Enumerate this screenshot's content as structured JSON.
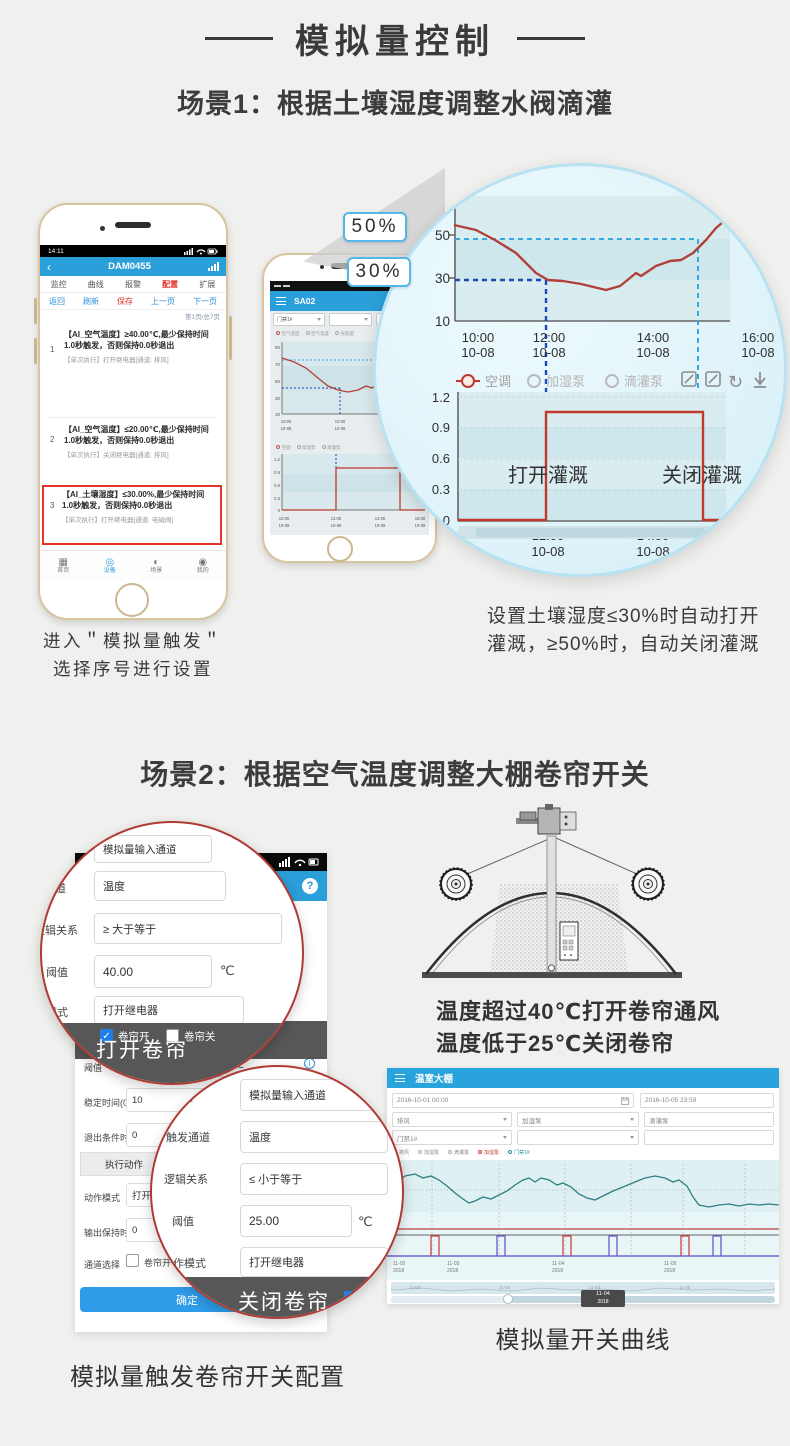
{
  "ui": {
    "back": "‹",
    "help": "?",
    "info": "i",
    "check": "✓"
  },
  "header": {
    "title": "模拟量控制"
  },
  "scene1": {
    "title": "场景1：根据土壤湿度调整水阀滴灌",
    "phone1": {
      "time": "14:11",
      "app_title": "DAM0455",
      "tabs": [
        "监控",
        "曲线",
        "报警",
        "配置",
        "扩展"
      ],
      "toolbar": [
        "返回",
        "刷新",
        "保存",
        "上一页",
        "下一页"
      ],
      "page_indicator": "第1页/总7页",
      "rules": [
        {
          "no": "1",
          "title": "【AI_空气温度】≥40.00℃,最少保持时间1.0秒触发，否则保持0.0秒退出",
          "action": "【单次执行】打开继电器[通道: 排风]"
        },
        {
          "no": "2",
          "title": "【AI_空气温度】≤20.00℃,最少保持时间1.0秒触发，否则保持0.0秒退出",
          "action": "【单次执行】关闭继电器[通道: 排风]"
        },
        {
          "no": "3",
          "title": "【AI_土壤湿度】≤30.00%,最少保持时间1.0秒触发，否则保持0.0秒退出",
          "action": "【单次执行】打开继电器[通道: 电磁阀]"
        }
      ],
      "nav": [
        "首页",
        "设备",
        "场景",
        "我的"
      ],
      "caption1": "进入＂模拟量触发＂",
      "caption2": "选择序号进行设置"
    },
    "phone2": {
      "app_title": "SA02",
      "device_select": "门禁1#",
      "legend1": [
        "空气湿度",
        "空气温度",
        "光照度"
      ],
      "yticks1": [
        "90",
        "70",
        "50",
        "30",
        "10"
      ],
      "xticks1": [
        "10:00",
        "12:00",
        "14:00"
      ],
      "xdate": "10-08",
      "legend2": [
        "空调",
        "加湿泵",
        "滴灌泵"
      ],
      "yticks2": [
        "1.2",
        "0.9",
        "0.6",
        "0.3",
        "0"
      ],
      "xticks2": [
        "10:00",
        "12:00",
        "14:00",
        "16:00"
      ]
    },
    "callout_high": "50%",
    "callout_low": "30%",
    "mag": {
      "hum_yticks": [
        "50",
        "30",
        "10"
      ],
      "hum_xticks": [
        {
          "t": "10:00",
          "d": "10-08"
        },
        {
          "t": "12:00",
          "d": "10-08"
        },
        {
          "t": "14:00",
          "d": "10-08"
        },
        {
          "t": "16:00",
          "d": "10-08"
        }
      ],
      "legend": [
        "空调",
        "加湿泵",
        "滴灌泵"
      ],
      "legend_sub": "门禁1#",
      "sw_yticks": [
        "1.2",
        "0.9",
        "0.6",
        "0.3",
        "0"
      ],
      "sw_xticks": [
        {
          "t": "12:00",
          "d": "10-08"
        },
        {
          "t": "14:00",
          "d": "10-08"
        }
      ],
      "open_label": "打开灌溉",
      "close_label": "关闭灌溉"
    },
    "note1": "设置土壤湿度≤30%时自动打开",
    "note2": "灌溉，≥50%时，自动关闭灌溉"
  },
  "scene2": {
    "title": "场景2：根据空气温度调整大棚卷帘开关",
    "phone": {
      "r_threshold": {
        "label": "阈值",
        "value": "25.00",
        "unit": "℃"
      },
      "r_stable": {
        "label": "稳定时间(0...",
        "value": "10"
      },
      "r_exit": {
        "label": "退出条件时...",
        "value": "0"
      },
      "sec_action": "执行动作",
      "r_mode": {
        "label": "动作模式",
        "value": "打开继电器"
      },
      "r_hold": {
        "label": "输出保持时...",
        "value": "0"
      },
      "r_channel": {
        "label": "通道选择",
        "value": "卷帘开"
      },
      "confirm": "确定"
    },
    "open_circle": {
      "f_source": "模拟量输入通道",
      "l_channel": "触发通道",
      "v_channel": "温度",
      "l_logic": "逻辑关系",
      "v_logic": "≥ 大于等于",
      "l_threshold": "阈值",
      "v_threshold": "40.00",
      "unit": "℃",
      "l_mode": "工作模式",
      "v_mode": "打开继电器",
      "check_open": "卷帘开",
      "check_close": "卷帘关",
      "partial": "择",
      "banner": "打开卷帘"
    },
    "close_circle": {
      "l_source": "触发源类型",
      "v_source": "模拟量输入通道",
      "l_channel": "触发通道",
      "v_channel": "温度",
      "l_logic": "逻辑关系",
      "v_logic": "≤ 小于等于",
      "l_threshold": "阈值",
      "v_threshold": "25.00",
      "unit": "℃",
      "l_mode": "动作模式",
      "v_mode": "打开继电器",
      "partial": "择",
      "partial2": "关",
      "banner": "关闭卷帘"
    },
    "form_caption": "模拟量触发卷帘开关配置",
    "gh_note1": "温度超过40℃打开卷帘通风",
    "gh_note2": "温度低于25℃关闭卷帘",
    "dashboard": {
      "title": "温室大棚",
      "date_from": "2016-10-01 00:00",
      "date_to": "2016-10-05 23:59",
      "select1": "排风",
      "select2": "加湿泵",
      "select3": "滴灌泵",
      "select4": "门禁1#",
      "legend": [
        "排风",
        "加湿泵",
        "滴灌泵",
        "加湿泵",
        "门禁1#"
      ],
      "xticks": [
        {
          "t": "11-02",
          "d": "2018"
        },
        {
          "t": "11-03",
          "d": "2018"
        },
        {
          "t": "11-04",
          "d": "2018"
        },
        {
          "t": "11-05",
          "d": "2018"
        }
      ],
      "badge": {
        "t": "11-04",
        "d": "2018"
      }
    },
    "chart_caption": "模拟量开关曲线"
  },
  "chart_data": [
    {
      "type": "line",
      "title": "土壤湿度放大曲线",
      "x": [
        "10:00",
        "10:30",
        "11:00",
        "11:30",
        "12:00",
        "12:30",
        "13:00",
        "13:30",
        "14:00",
        "14:30",
        "15:00",
        "15:30",
        "16:00"
      ],
      "values": [
        54,
        51,
        46,
        39,
        31,
        28,
        27,
        25,
        28,
        34,
        44,
        56,
        60
      ],
      "yticks": [
        10,
        30,
        50
      ],
      "xlabel_date": "10-08",
      "thresholds": {
        "open_irrigation_below": 30,
        "close_irrigation_above": 50
      }
    },
    {
      "type": "line",
      "title": "灌溉开关放大曲线",
      "x": [
        "10:00",
        "12:00",
        "15:00",
        "16:00"
      ],
      "values": [
        0,
        1,
        1,
        0
      ],
      "yticks": [
        0,
        0.3,
        0.6,
        0.9,
        1.2
      ],
      "annotations": [
        "打开灌溉",
        "关闭灌溉"
      ]
    },
    {
      "type": "line",
      "title": "模拟量开关曲线（温室大棚后台）",
      "x": [
        "11-02 2018",
        "11-03 2018",
        "11-04 2018",
        "11-05 2018"
      ],
      "series": [
        {
          "name": "温度曲线"
        },
        {
          "name": "开关通道脉冲"
        }
      ],
      "legend_position": "top"
    }
  ]
}
